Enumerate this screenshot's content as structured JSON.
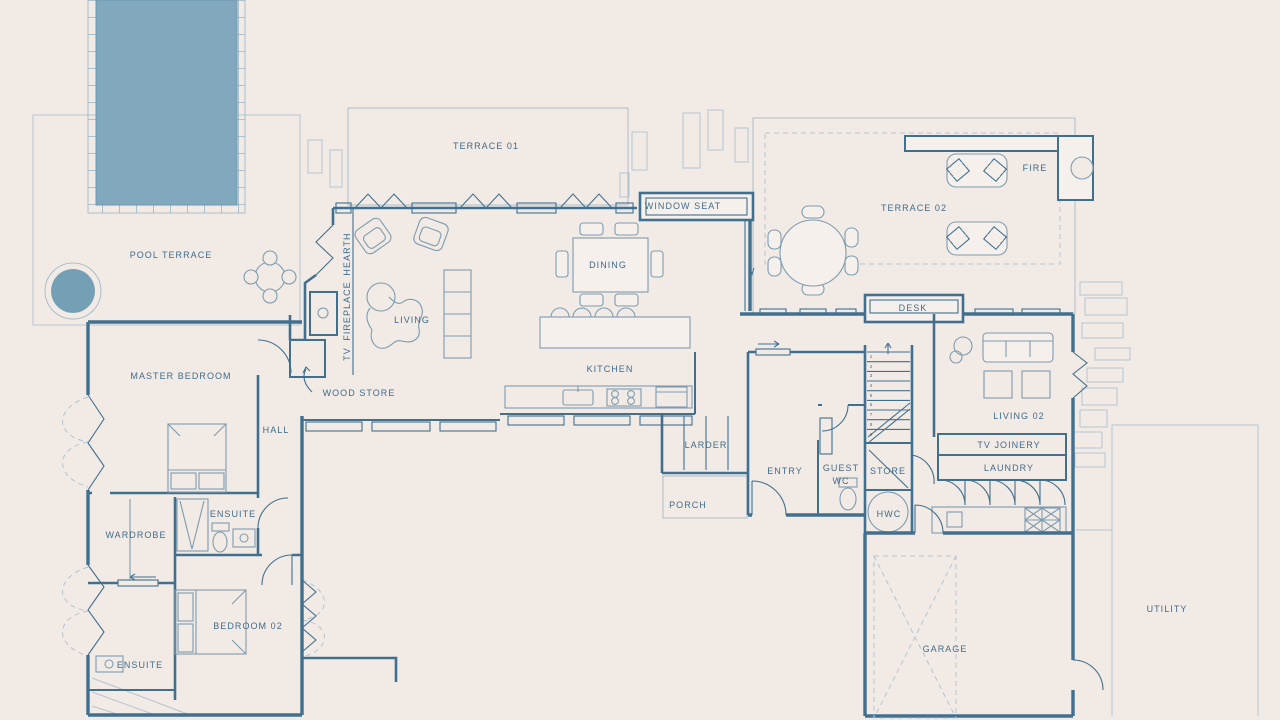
{
  "plan": {
    "type": "architectural-floor-plan",
    "colors": {
      "background": "#f2eae5",
      "wall_line": "#41708f",
      "light_line": "#b3c5d1",
      "grid_line": "#98b3c4",
      "furniture_line": "#7d9cb0",
      "pool_water": "#81a8bc",
      "hot_tub_water": "#74a0b6",
      "cushion_blue": "#5e90ae",
      "label_text": "#3e6c8c",
      "room_fill": "#f6f0ec"
    },
    "labels": {
      "pool_terrace": "POOL TERRACE",
      "terrace_01": "TERRACE 01",
      "window_seat": "WINDOW SEAT",
      "terrace_02": "TERRACE 02",
      "fire": "FIRE",
      "desk": "DESK",
      "dining": "DINING",
      "living": "LIVING",
      "kitchen": "KITCHEN",
      "hearth": "HEARTH",
      "fireplace": "FIREPLACE",
      "tv": "TV",
      "wood_store": "WOOD STORE",
      "master_bedroom": "MASTER BEDROOM",
      "hall": "HALL",
      "wardrobe": "WARDROBE",
      "ensuite_master": "ENSUITE",
      "bedroom_02": "BEDROOM 02",
      "ensuite_02": "ENSUITE",
      "larder": "LARDER",
      "porch": "PORCH",
      "entry": "ENTRY",
      "guest_wc_line1": "GUEST",
      "guest_wc_line2": "WC",
      "store": "STORE",
      "hwc": "HWC",
      "living_02": "LIVING 02",
      "tv_joinery": "TV JOINERY",
      "laundry": "LAUNDRY",
      "garage": "GARAGE",
      "utility": "UTILITY"
    },
    "stair_treads": {
      "t1": "1",
      "t2": "2",
      "t3": "3",
      "t4": "4",
      "t5": "5",
      "t6": "6",
      "t7": "7",
      "t8": "8",
      "t9": "9"
    }
  }
}
